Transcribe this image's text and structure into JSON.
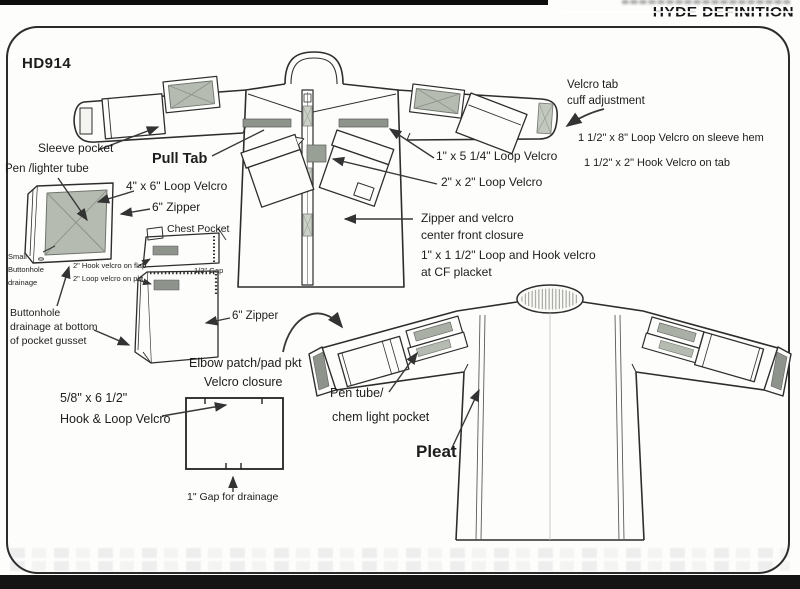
{
  "header": {
    "brand": "HYDE DEFINITION"
  },
  "doc": {
    "model": "HD914"
  },
  "labels": {
    "sleeve_pocket": "Sleeve pocket",
    "pen_lighter_tube": "Pen /lighter tube",
    "pull_tab": "Pull Tab",
    "loop_velcro_4x6": "4\" x 6\" Loop Velcro",
    "zipper_6_upper": "6\" Zipper",
    "chest_pocket": "Chest Pocket",
    "hook_velcro_flap": "2\" Hook velcro on flap",
    "loop_velcro_pkt": "2\" Loop velcro on pkt",
    "half_inch_gap": "1/2\" Gap",
    "small_buttonhole": "Small\nButtonhole\ndrainage",
    "buttonhole_gusset": "Buttonhole\ndrainage at bottom\nof pocket gusset",
    "zipper_6_lower": "6\" Zipper",
    "elbow_patch": "Elbow patch/pad pkt",
    "velcro_closure": "Velcro closure",
    "hook_loop_size": "5/8\" x 6 1/2\"",
    "hook_loop_velcro": "Hook & Loop Velcro",
    "gap_drainage": "1\" Gap for drainage",
    "velcro_tab": "Velcro tab",
    "cuff_adjustment": "cuff adjustment",
    "loop_sleeve_hem": "1 1/2\" x 8\" Loop Velcro  on sleeve hem",
    "hook_on_tab": "1 1/2\" x 2\" Hook Velcro on tab",
    "loop_1x5": "1\" x 5 1/4\"  Loop Velcro",
    "loop_2x2": "2\" x 2\"  Loop Velcro",
    "zipper_velcro_cf": "Zipper and velcro\ncenter front closure",
    "cf_placket": "1\" x 1 1/2\"  Loop and Hook velcro\nat CF placket",
    "pen_tube_1": "Pen tube/",
    "pen_tube_2": "chem light pocket",
    "pleat": "Pleat"
  },
  "colors": {
    "line": "#2d2d2d",
    "velcro_fill": "#b5bbb0",
    "strip_fill": "#8e938b",
    "frame": "#2b2b2b",
    "bar": "#141414"
  }
}
